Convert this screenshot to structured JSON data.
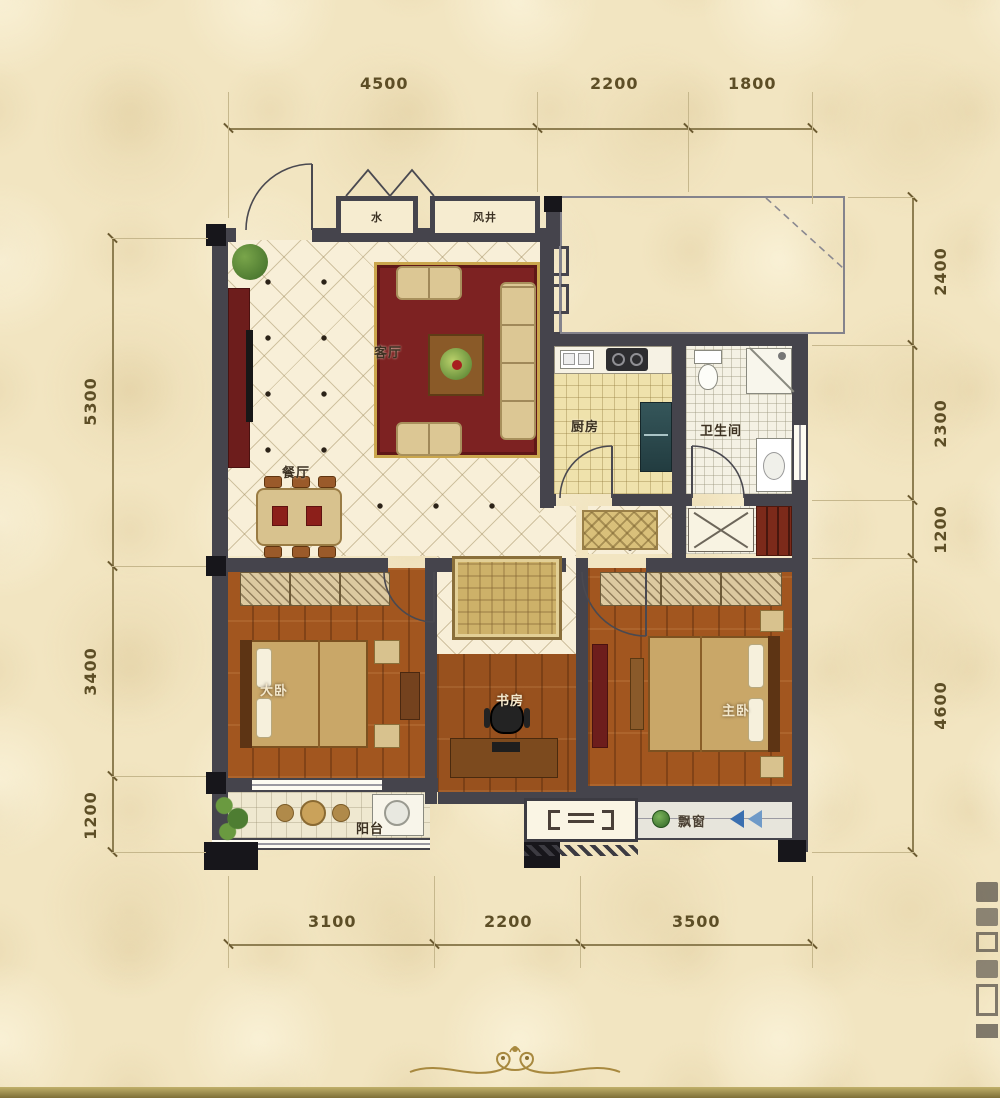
{
  "plan": {
    "type": "apartment-floor-plan",
    "rooms": {
      "living": "客厅",
      "dining": "餐厅",
      "kitchen": "厨房",
      "bath": "卫生间",
      "bedroom_left": "大卧",
      "study": "书房",
      "master": "主卧",
      "balcony": "阳台",
      "bay_window": "飘窗",
      "shaft_water": "水",
      "shaft_air": "风井"
    },
    "dimensions": {
      "top": [
        "4500",
        "2200",
        "1800"
      ],
      "bottom": [
        "3100",
        "2200",
        "3500"
      ],
      "left": [
        "5300",
        "3400",
        "1200"
      ],
      "right": [
        "2400",
        "2300",
        "1200",
        "4600"
      ]
    },
    "colors": {
      "background": "#f2e5c1",
      "wall": "#45444c",
      "wood_floor": "#a2561f",
      "rug_red": "#7d2222",
      "gold_trim": "#caa64d",
      "accent_blue": "#3a6fb0",
      "badge_green": "#3f7d36",
      "bottom_band": "#8f7f42"
    }
  }
}
